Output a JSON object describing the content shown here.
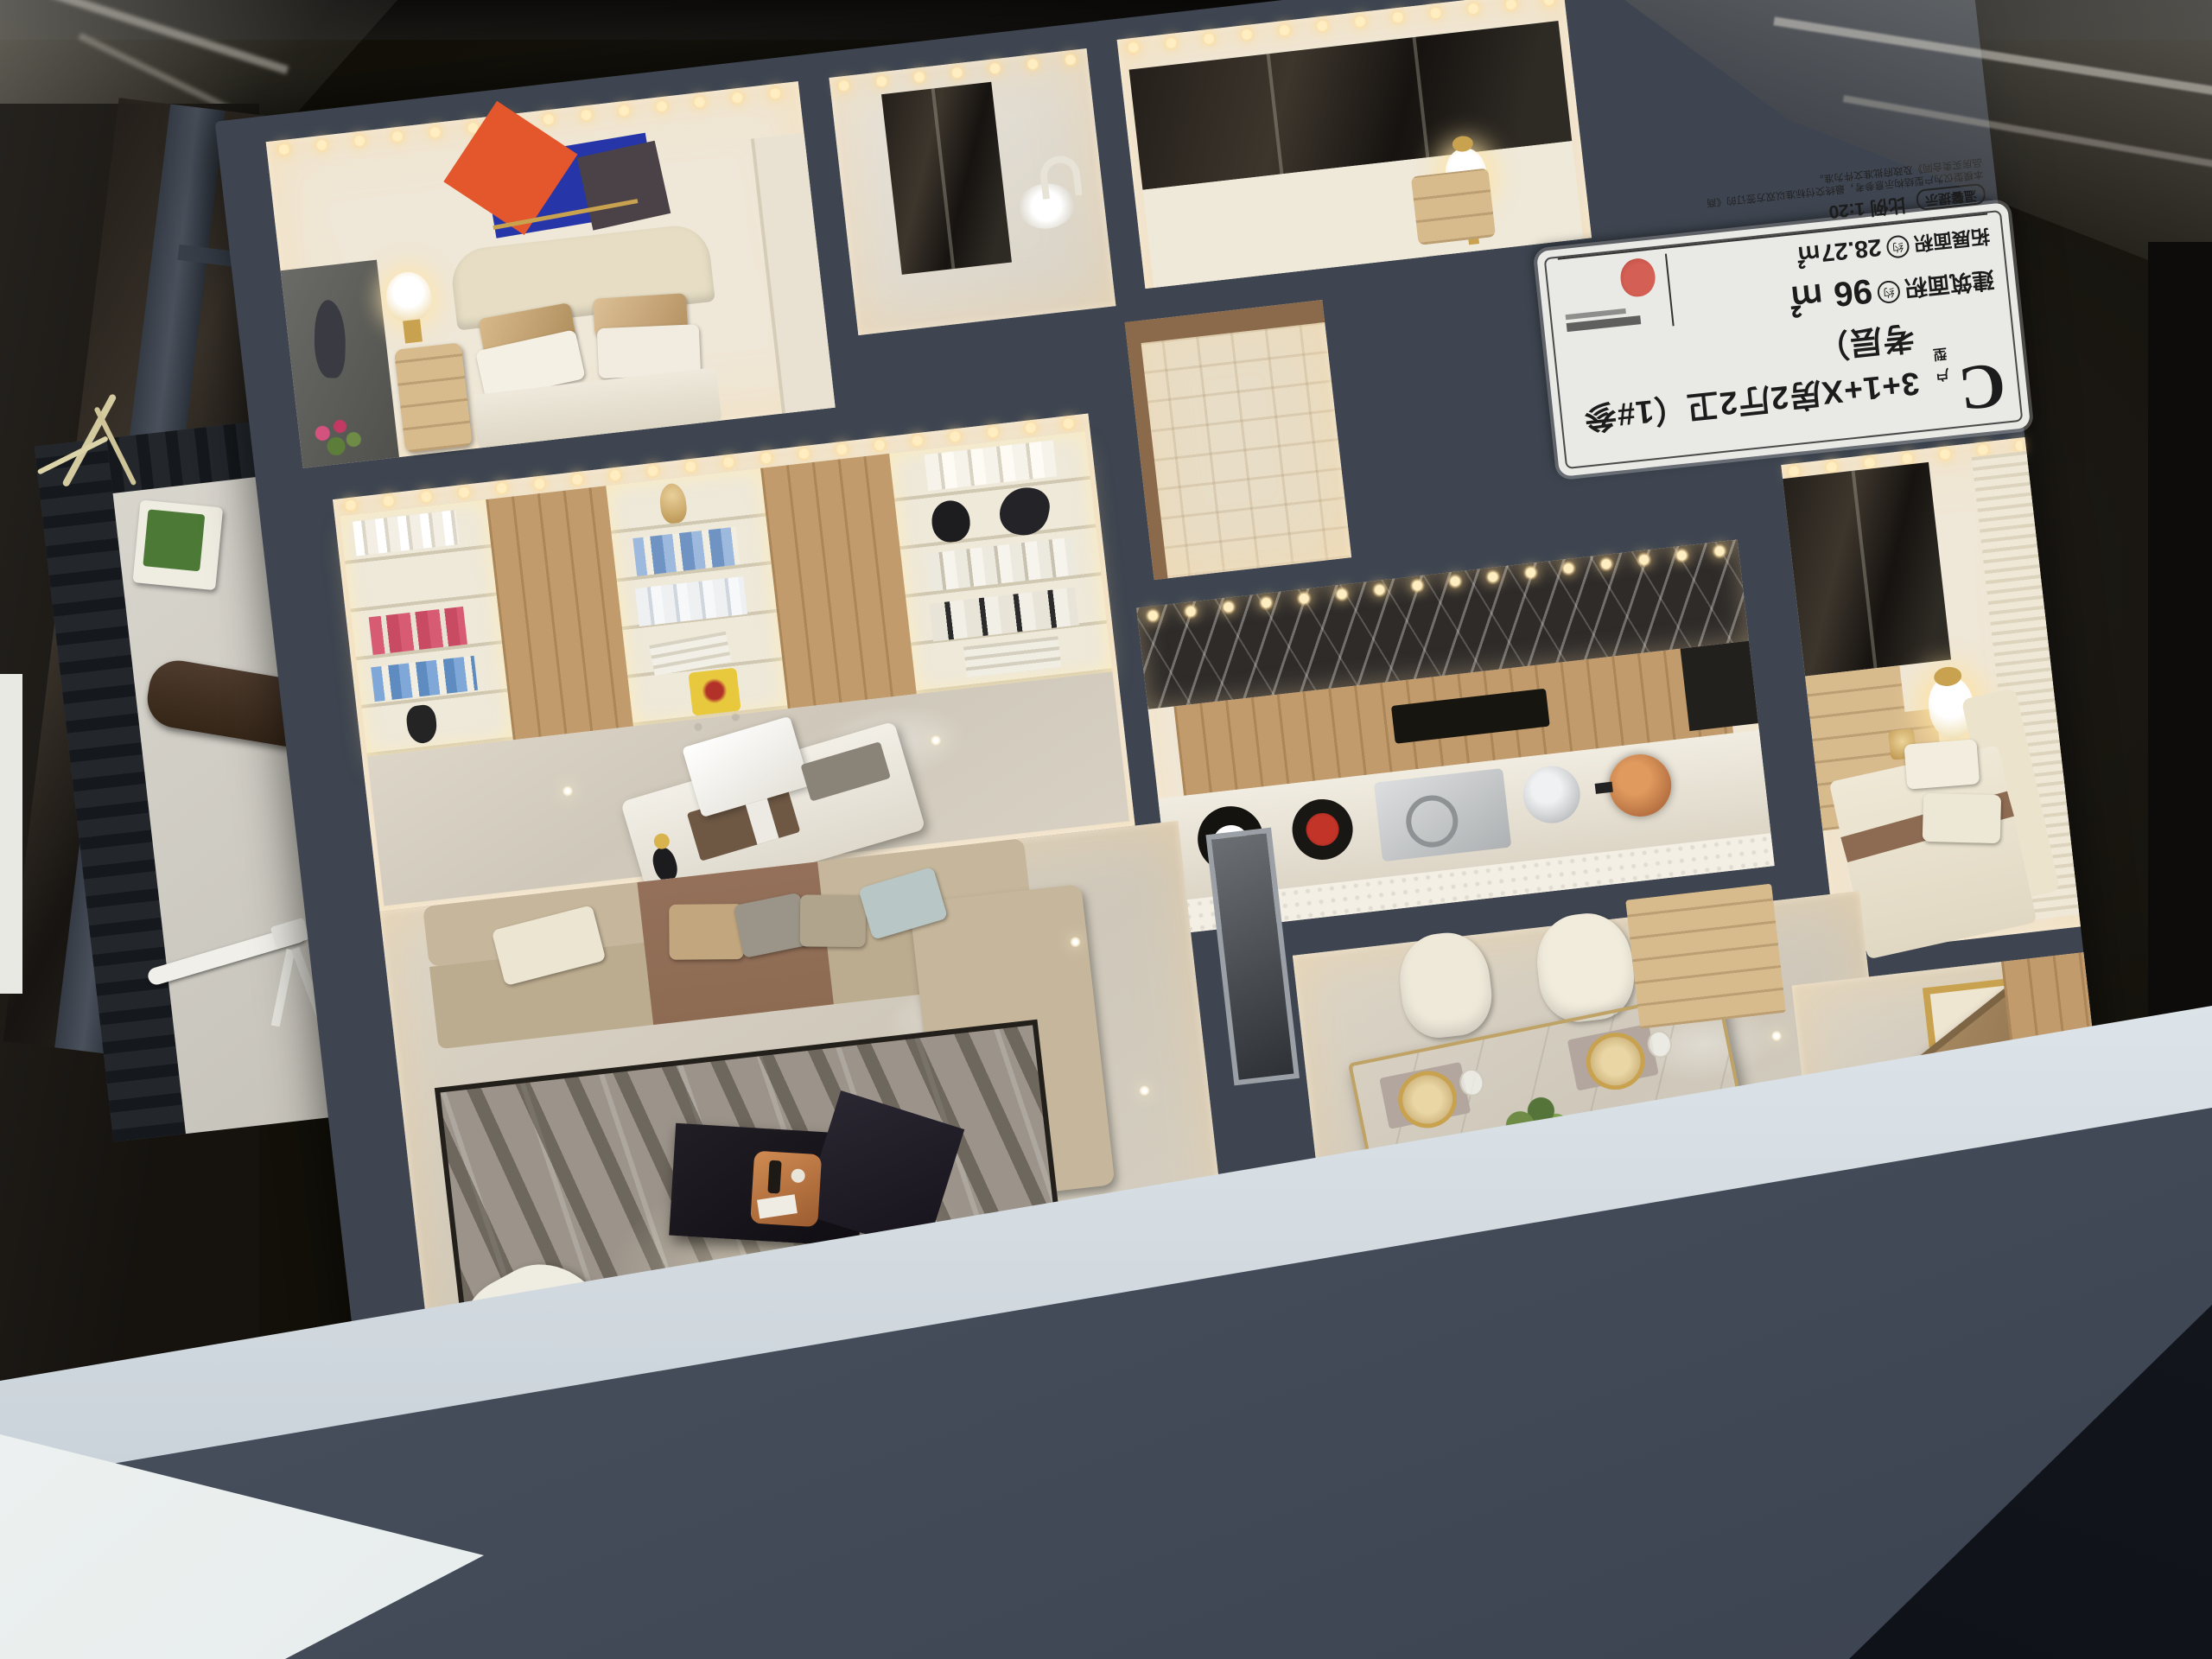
{
  "placard": {
    "unit_letter": "C",
    "unit_suffix": "户型",
    "title": "3+1+X房2厅2卫（1#参考层）",
    "area_label_build": "建筑面积",
    "approx_badge": "约",
    "area_value_build": "96 ㎡",
    "area_label_ext": "拓展面积",
    "area_value_ext": "28.27㎡",
    "tip_badge": "温馨提示",
    "scale_text": "比例 1:20",
    "disclaimer": "本模型仅为户型结构示意参考，最终交付标准以双方签订的《商品房买卖合同》及政府批准文件为准。"
  },
  "palette": {
    "interior_cream": "#efe7d7",
    "wall_slate": "#3e4550",
    "wall_slate_light": "#59616c",
    "glow_warm": "#ffe2a8",
    "floor_marble": "#d9d2c4",
    "wood": "#c19b6b",
    "wood_light": "#d8bb8d",
    "sofa_beige": "#c6b79c",
    "sofa_brown": "#8d6b52",
    "pillow_blue": "#b9c6c6",
    "rug_gray": "#9c948a",
    "marble_black": "#2e2b29",
    "accent_orange": "#e4562b",
    "accent_blue": "#2636a8",
    "gold": "#c9a24f",
    "copper": "#b06a3d",
    "plant_green": "#5d7d3a",
    "white_soft": "#f3efe6",
    "base_fascia": "#dde4e9",
    "foreground_slate": "#49515f",
    "corner_navy": "#0c0e14",
    "glass_dark": "#211d19",
    "railing_black": "#23272c",
    "placard_bg": "#e9e9e5",
    "placard_text": "#1c1c1c",
    "seal_red": "#b53226"
  }
}
